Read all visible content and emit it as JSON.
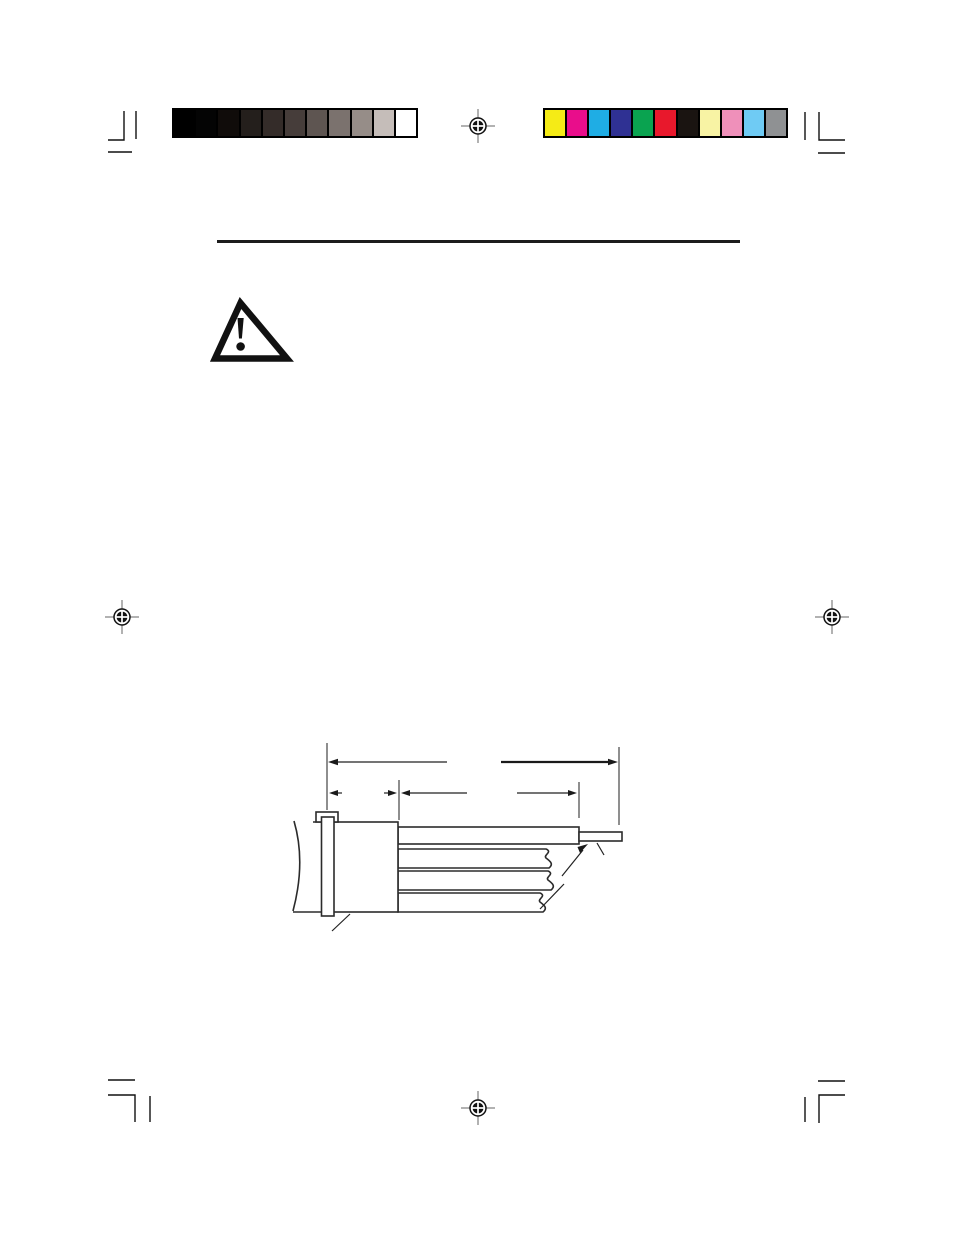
{
  "page": {
    "kind": "print-proof-document-page",
    "background": "#ffffff",
    "description": "Blank book/manual page proof showing printer calibration bars, registration targets, corner crop marks, a section rule, a safety warning triangle, and an unlabeled dimensioned line drawing of a panel-mounted connector with cables."
  },
  "printer_marks": {
    "grayscale_bar": {
      "swatches": [
        "#000000",
        "#040404",
        "#100c0a",
        "#241f1c",
        "#342c29",
        "#463d3a",
        "#5e5551",
        "#7b726e",
        "#968d88",
        "#c5bdb9",
        "#ffffff"
      ]
    },
    "color_bar": {
      "swatches": [
        "#f5eb16",
        "#e90d8b",
        "#1fade4",
        "#2f3193",
        "#0aa350",
        "#e8182c",
        "#1a1411",
        "#f8f3a4",
        "#ef90ba",
        "#6fcbf4",
        "#8f9193"
      ]
    },
    "registration_marks_count": 4,
    "crop_mark_corners": [
      "top-left",
      "top-right",
      "bottom-left",
      "bottom-right"
    ]
  },
  "content": {
    "section_rule_color": "#1d1d1d",
    "warning_icon": "warning-triangle-exclamation",
    "diagram": {
      "type": "technical-line-drawing",
      "subject": "side view of a panel-mounted connector: mounting screw and flange at left, connector body, one straight pin/cable at top with small end pin, and three cables below drawn with break symbols",
      "dimension_lines": [
        {
          "row": "top",
          "span": "flange to pin tip",
          "label": ""
        },
        {
          "row": "second",
          "span": "flange thickness",
          "label": ""
        },
        {
          "row": "second",
          "span": "connector body to cable end",
          "label": ""
        }
      ],
      "labels_visible": false
    }
  }
}
